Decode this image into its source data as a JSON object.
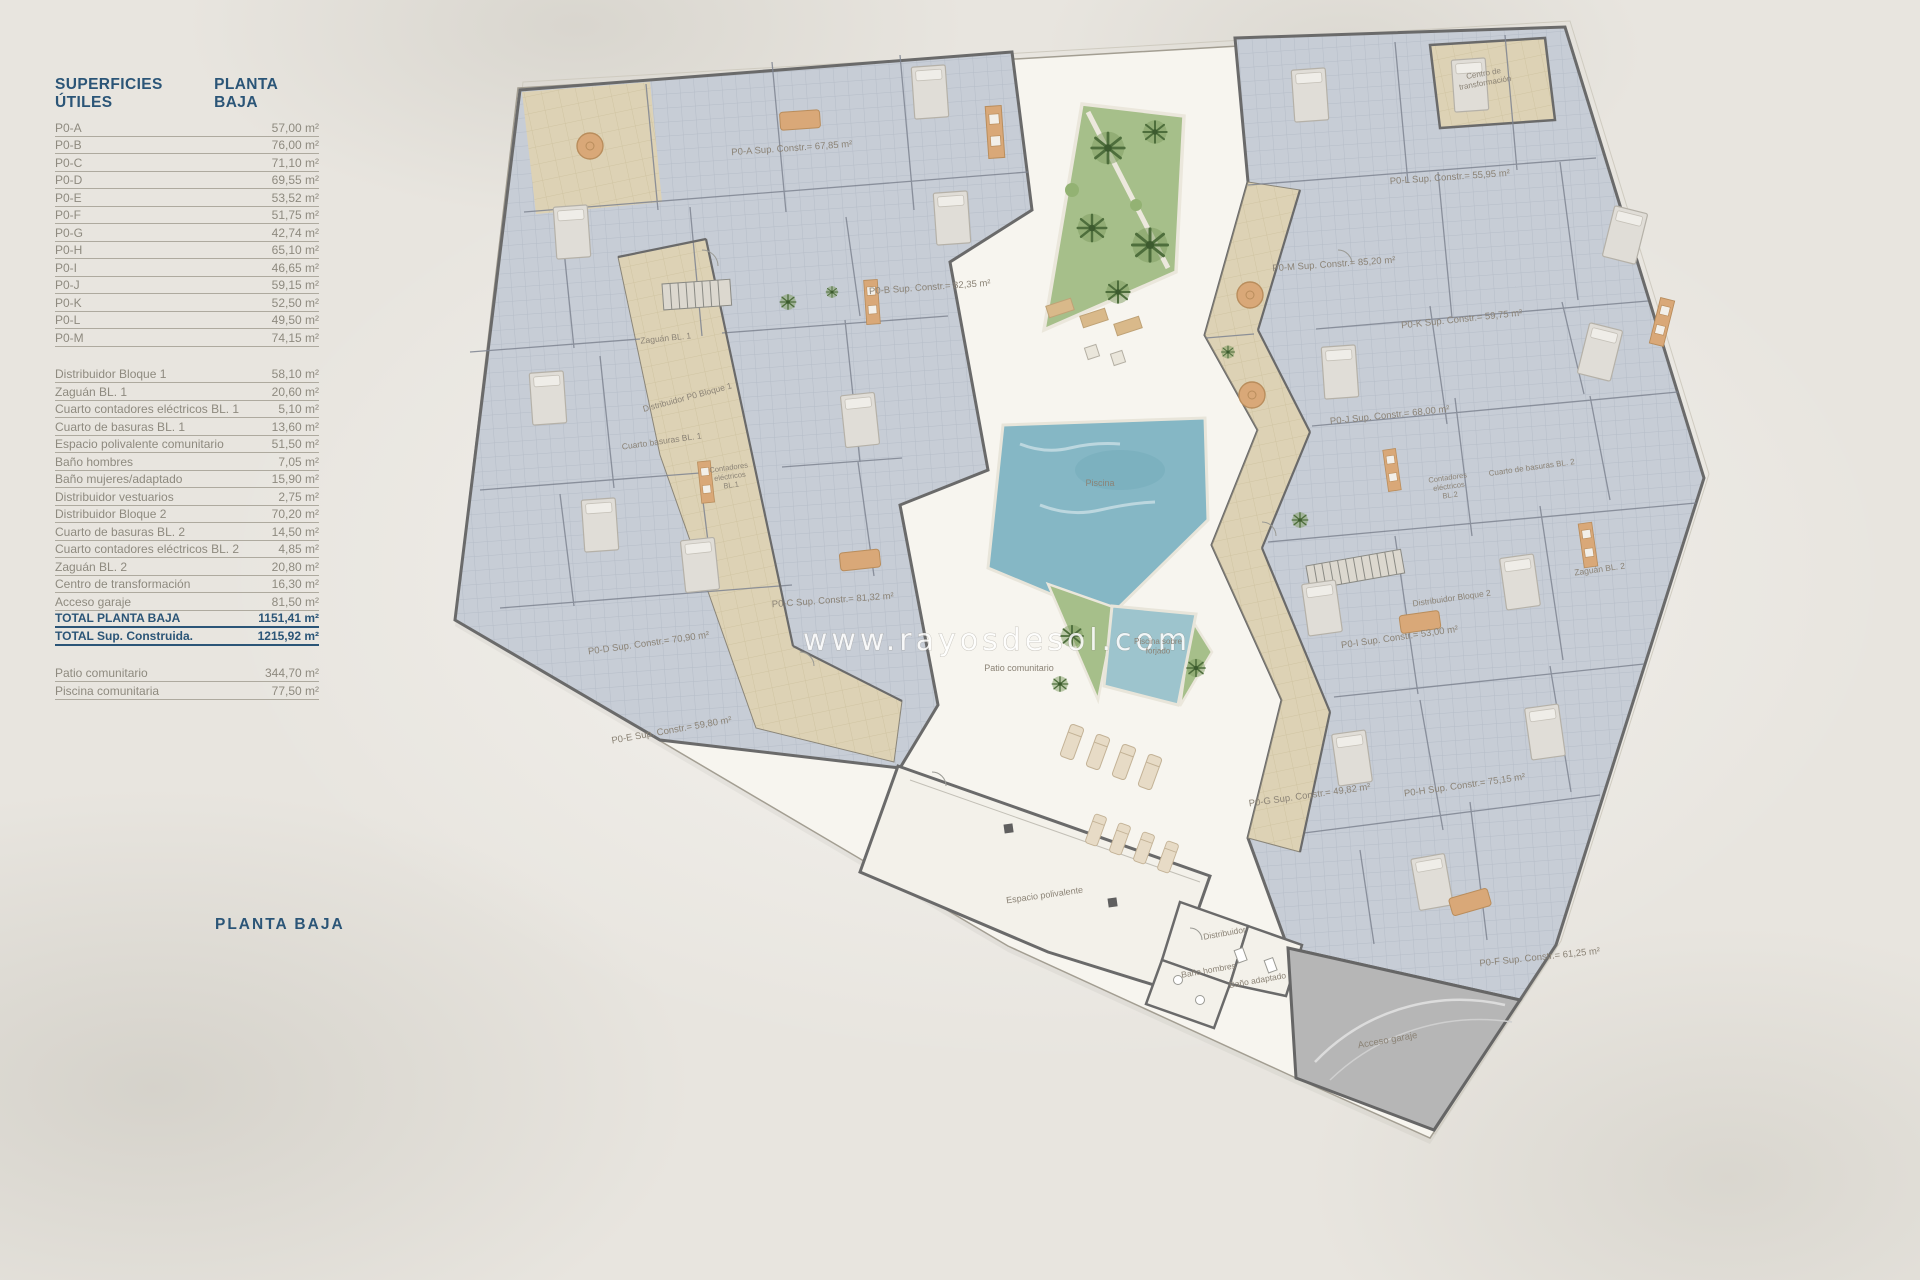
{
  "legend": {
    "title": "SUPERFICIES ÚTILES",
    "subtitle": "PLANTA BAJA",
    "groups": [
      {
        "rows": [
          {
            "label": "P0-A",
            "value": "57,00 m²"
          },
          {
            "label": "P0-B",
            "value": "76,00 m²"
          },
          {
            "label": "P0-C",
            "value": "71,10 m²"
          },
          {
            "label": "P0-D",
            "value": "69,55 m²"
          },
          {
            "label": "P0-E",
            "value": "53,52 m²"
          },
          {
            "label": "P0-F",
            "value": "51,75 m²"
          },
          {
            "label": "P0-G",
            "value": "42,74 m²"
          },
          {
            "label": "P0-H",
            "value": "65,10 m²"
          },
          {
            "label": "P0-I",
            "value": "46,65 m²"
          },
          {
            "label": "P0-J",
            "value": "59,15 m²"
          },
          {
            "label": "P0-K",
            "value": "52,50 m²"
          },
          {
            "label": "P0-L",
            "value": "49,50 m²"
          },
          {
            "label": "P0-M",
            "value": "74,15 m²"
          }
        ]
      },
      {
        "rows": [
          {
            "label": "Distribuidor Bloque 1",
            "value": "58,10 m²"
          },
          {
            "label": "Zaguán BL. 1",
            "value": "20,60 m²"
          },
          {
            "label": "Cuarto contadores eléctricos BL. 1",
            "value": "5,10 m²"
          },
          {
            "label": "Cuarto de basuras BL. 1",
            "value": "13,60 m²"
          },
          {
            "label": "Espacio polivalente comunitario",
            "value": "51,50 m²"
          },
          {
            "label": "Baño hombres",
            "value": "7,05 m²"
          },
          {
            "label": "Baño mujeres/adaptado",
            "value": "15,90 m²"
          },
          {
            "label": "Distribuidor vestuarios",
            "value": "2,75 m²"
          },
          {
            "label": "Distribuidor Bloque 2",
            "value": "70,20 m²"
          },
          {
            "label": "Cuarto de basuras BL. 2",
            "value": "14,50 m²"
          },
          {
            "label": "Cuarto contadores eléctricos BL. 2",
            "value": "4,85 m²"
          },
          {
            "label": "Zaguán BL. 2",
            "value": "20,80 m²"
          },
          {
            "label": "Centro de transformación",
            "value": "16,30 m²"
          },
          {
            "label": "Acceso garaje",
            "value": "81,50 m²"
          },
          {
            "label": "TOTAL PLANTA BAJA",
            "value": "1151,41 m²",
            "total": true
          },
          {
            "label": "TOTAL Sup. Construida.",
            "value": "1215,92 m²",
            "total": true
          }
        ]
      },
      {
        "rows": [
          {
            "label": "Patio comunitario",
            "value": "344,70 m²"
          },
          {
            "label": "Piscina comunitaria",
            "value": "77,50 m²"
          }
        ]
      }
    ]
  },
  "footer_title": "PLANTA BAJA",
  "watermark": "www.rayosdesol.com",
  "plan": {
    "labels": [
      {
        "x": 792,
        "y": 151,
        "rot": -4,
        "size": 9.5,
        "text": "P0-A Sup. Constr.= 67,85 m²"
      },
      {
        "x": 930,
        "y": 290,
        "rot": -4,
        "size": 9.5,
        "text": "P0-B Sup. Constr.= 82,35 m²"
      },
      {
        "x": 666,
        "y": 341,
        "rot": -6,
        "size": 8.5,
        "text": "Zaguán BL. 1"
      },
      {
        "x": 688,
        "y": 400,
        "rot": -15,
        "size": 8.5,
        "text": "Distribuidor P0 Bloque 1"
      },
      {
        "x": 662,
        "y": 444,
        "rot": -8,
        "size": 8.5,
        "text": "Cuarto basuras BL. 1"
      },
      {
        "x": 729,
        "y": 470,
        "rot": -8,
        "size": 7.5,
        "lines": [
          "Contadores",
          "eléctricos",
          "BL.1"
        ]
      },
      {
        "x": 833,
        "y": 603,
        "rot": -4,
        "size": 9.5,
        "text": "P0-C Sup. Constr.= 81,32 m²"
      },
      {
        "x": 649,
        "y": 646,
        "rot": -8,
        "size": 9.5,
        "text": "P0-D Sup. Constr.= 70,90 m²"
      },
      {
        "x": 672,
        "y": 733,
        "rot": -10,
        "size": 9.5,
        "text": "P0-E Sup. Constr.= 59,80 m²"
      },
      {
        "x": 1334,
        "y": 267,
        "rot": -4,
        "size": 9.5,
        "text": "P0-M Sup. Constr.= 85,20 m²"
      },
      {
        "x": 1450,
        "y": 180,
        "rot": -4,
        "size": 9.5,
        "text": "P0-L Sup. Constr.= 55,95 m²"
      },
      {
        "x": 1484,
        "y": 76,
        "rot": -10,
        "size": 8,
        "lines": [
          "Centro de",
          "transformación"
        ]
      },
      {
        "x": 1462,
        "y": 322,
        "rot": -6,
        "size": 9.5,
        "text": "P0-K Sup. Constr.= 59,75 m²"
      },
      {
        "x": 1390,
        "y": 418,
        "rot": -6,
        "size": 9.5,
        "text": "P0-J Sup. Constr.= 68,00 m²"
      },
      {
        "x": 1400,
        "y": 640,
        "rot": -8,
        "size": 9.5,
        "text": "P0-I Sup. Constr.= 53,00 m²"
      },
      {
        "x": 1452,
        "y": 601,
        "rot": -8,
        "size": 8.5,
        "text": "Distribuidor Bloque 2"
      },
      {
        "x": 1600,
        "y": 572,
        "rot": -8,
        "size": 8.5,
        "text": "Zaguán BL. 2"
      },
      {
        "x": 1532,
        "y": 470,
        "rot": -8,
        "size": 8,
        "text": "Cuarto de basuras BL. 2"
      },
      {
        "x": 1448,
        "y": 480,
        "rot": -8,
        "size": 7.5,
        "lines": [
          "Contadores",
          "eléctricos",
          "BL.2"
        ]
      },
      {
        "x": 1100,
        "y": 486,
        "rot": 0,
        "size": 9,
        "text": "Piscina"
      },
      {
        "x": 1158,
        "y": 644,
        "rot": 0,
        "size": 8,
        "lines": [
          "Piscina sobre",
          "forjado"
        ]
      },
      {
        "x": 1019,
        "y": 671,
        "rot": 0,
        "size": 9,
        "text": "Patio comunitario"
      },
      {
        "x": 1045,
        "y": 898,
        "rot": -8,
        "size": 9,
        "text": "Espacio polivalente"
      },
      {
        "x": 1225,
        "y": 936,
        "rot": -10,
        "size": 8.5,
        "text": "Distribuidor"
      },
      {
        "x": 1209,
        "y": 973,
        "rot": -10,
        "size": 8.5,
        "text": "Baño hombres"
      },
      {
        "x": 1258,
        "y": 983,
        "rot": -10,
        "size": 8.5,
        "text": "Baño adaptado"
      },
      {
        "x": 1388,
        "y": 1043,
        "rot": -10,
        "size": 9.5,
        "text": "Acceso garaje"
      },
      {
        "x": 1540,
        "y": 960,
        "rot": -6,
        "size": 9.5,
        "text": "P0-F Sup. Constr.= 61,25 m²"
      },
      {
        "x": 1310,
        "y": 798,
        "rot": -8,
        "size": 9.5,
        "text": "P0-G Sup. Constr.= 49,82 m²"
      },
      {
        "x": 1465,
        "y": 788,
        "rot": -8,
        "size": 9.5,
        "text": "P0-H Sup. Constr.= 75,15 m²"
      }
    ]
  },
  "colors": {
    "accent_blue": "#2b5577",
    "text_gray": "#8e8a7f",
    "label_gray": "#8b8376",
    "apartment": "#c7cdd6",
    "corridor": "#ddd2b5",
    "wall": "#6a6a6a",
    "pool": "#85b7c5",
    "garden": "#a6bf8a",
    "garage": "#b6b6b6"
  }
}
